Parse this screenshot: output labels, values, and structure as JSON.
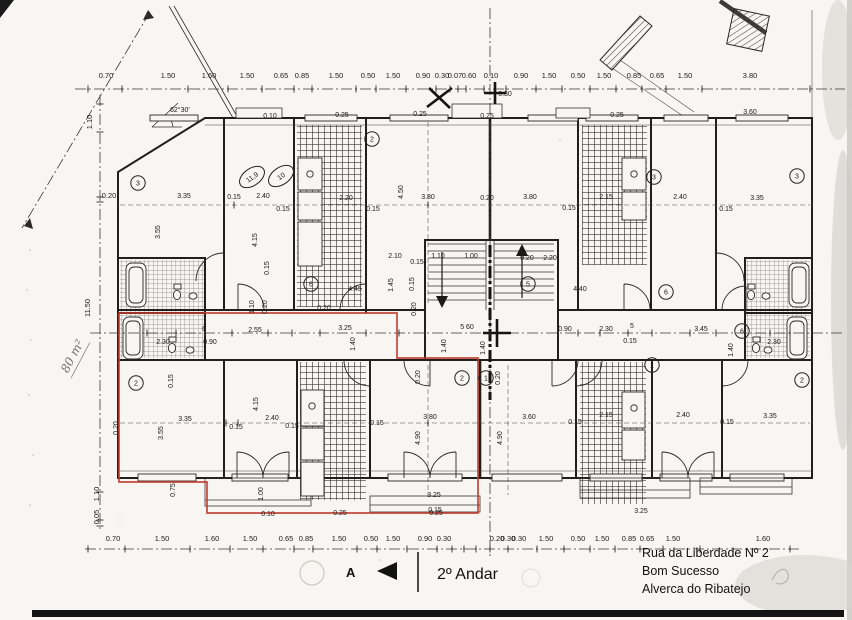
{
  "title": {
    "floor": "2º Andar",
    "marker": "A"
  },
  "address": [
    "Rua da Liberdade Nº 2",
    "Bom Sucesso",
    "Alverca do Ribatejo"
  ],
  "notes": {
    "area_handwritten": "80 m²",
    "angle": "62°30'"
  },
  "colors": {
    "paper": "#f7f6f2",
    "ink": "#1f1e1c",
    "red_outline": "#c0392b",
    "pencil": "#b0ada6"
  },
  "dimensions": {
    "top_row": {
      "y": 78,
      "items": [
        {
          "t": "0.70",
          "x": 106
        },
        {
          "t": "1.50",
          "x": 168
        },
        {
          "t": "1.60",
          "x": 209
        },
        {
          "t": "1.50",
          "x": 247
        },
        {
          "t": "0.65",
          "x": 281
        },
        {
          "t": "0.85",
          "x": 302
        },
        {
          "t": "1.50",
          "x": 336
        },
        {
          "t": "0.50",
          "x": 368
        },
        {
          "t": "1.50",
          "x": 393
        },
        {
          "t": "0.90",
          "x": 423
        },
        {
          "t": "0.30",
          "x": 442
        },
        {
          "t": "0.07",
          "x": 455
        },
        {
          "t": "0.60",
          "x": 469
        },
        {
          "t": "0.10",
          "x": 491
        },
        {
          "t": "0.90",
          "x": 521
        },
        {
          "t": "1.50",
          "x": 549
        },
        {
          "t": "0.50",
          "x": 578
        },
        {
          "t": "1.50",
          "x": 604
        },
        {
          "t": "0.85",
          "x": 634
        },
        {
          "t": "0.65",
          "x": 657
        },
        {
          "t": "1.50",
          "x": 685
        },
        {
          "t": "3.80",
          "x": 750
        }
      ]
    },
    "bottom_row": {
      "y": 541,
      "items": [
        {
          "t": "0.70",
          "x": 113
        },
        {
          "t": "1.50",
          "x": 162
        },
        {
          "t": "1.60",
          "x": 212
        },
        {
          "t": "1.50",
          "x": 250
        },
        {
          "t": "0.65",
          "x": 286
        },
        {
          "t": "0.85",
          "x": 306
        },
        {
          "t": "1.50",
          "x": 339
        },
        {
          "t": "0.50",
          "x": 371
        },
        {
          "t": "1.50",
          "x": 393
        },
        {
          "t": "0.90",
          "x": 425
        },
        {
          "t": "0.30",
          "x": 444
        },
        {
          "t": "0.20",
          "x": 497
        },
        {
          "t": "0.30",
          "x": 508
        },
        {
          "t": "0.30",
          "x": 519
        },
        {
          "t": "1.50",
          "x": 546
        },
        {
          "t": "0.50",
          "x": 578
        },
        {
          "t": "1.50",
          "x": 602
        },
        {
          "t": "0.85",
          "x": 629
        },
        {
          "t": "0.65",
          "x": 647
        },
        {
          "t": "1.50",
          "x": 673
        },
        {
          "t": "1.60",
          "x": 763
        }
      ]
    },
    "left_col": [
      {
        "t": "1.10",
        "x": 92,
        "y": 122,
        "r": -90
      },
      {
        "t": "0.20",
        "x": 109,
        "y": 198
      },
      {
        "t": "11.50",
        "x": 90,
        "y": 308,
        "r": -90
      },
      {
        "t": "1.10",
        "x": 99,
        "y": 494,
        "r": -90
      },
      {
        "t": "0.05",
        "x": 99,
        "y": 517,
        "r": -90
      }
    ],
    "interior": [
      {
        "t": "3.35",
        "x": 184,
        "y": 198
      },
      {
        "t": "0.15",
        "x": 234,
        "y": 199
      },
      {
        "t": "2.40",
        "x": 263,
        "y": 198
      },
      {
        "t": "0.15",
        "x": 283,
        "y": 211
      },
      {
        "t": "3.55",
        "x": 160,
        "y": 232,
        "r": -90
      },
      {
        "t": "4.15",
        "x": 257,
        "y": 240,
        "r": -90
      },
      {
        "t": "0.15",
        "x": 269,
        "y": 268,
        "r": -90
      },
      {
        "t": "2.20",
        "x": 346,
        "y": 200
      },
      {
        "t": "0.15",
        "x": 373,
        "y": 211
      },
      {
        "t": "3.80",
        "x": 428,
        "y": 199
      },
      {
        "t": "4.50",
        "x": 403,
        "y": 192,
        "r": -90
      },
      {
        "t": "0.20",
        "x": 487,
        "y": 200
      },
      {
        "t": "2.10",
        "x": 395,
        "y": 258
      },
      {
        "t": "0.15",
        "x": 417,
        "y": 264
      },
      {
        "t": "1.10",
        "x": 438,
        "y": 258
      },
      {
        "t": "1.00",
        "x": 471,
        "y": 258
      },
      {
        "t": "0.20",
        "x": 527,
        "y": 260
      },
      {
        "t": "2.20",
        "x": 550,
        "y": 260
      },
      {
        "t": "4.45",
        "x": 355,
        "y": 291
      },
      {
        "t": "1.45",
        "x": 393,
        "y": 285,
        "r": -90
      },
      {
        "t": "0.15",
        "x": 414,
        "y": 284,
        "r": -90
      },
      {
        "t": "4.40",
        "x": 580,
        "y": 291
      },
      {
        "t": "3.80",
        "x": 530,
        "y": 199
      },
      {
        "t": "0.15",
        "x": 569,
        "y": 210
      },
      {
        "t": "2.15",
        "x": 606,
        "y": 199
      },
      {
        "t": "2.40",
        "x": 680,
        "y": 199
      },
      {
        "t": "0.15",
        "x": 726,
        "y": 211
      },
      {
        "t": "3.35",
        "x": 757,
        "y": 200
      },
      {
        "t": "6",
        "x": 204,
        "y": 331
      },
      {
        "t": "2.55",
        "x": 255,
        "y": 332
      },
      {
        "t": "0.90",
        "x": 210,
        "y": 344
      },
      {
        "t": "2.30",
        "x": 163,
        "y": 344
      },
      {
        "t": "1.10",
        "x": 254,
        "y": 307,
        "r": -90
      },
      {
        "t": "0.20",
        "x": 267,
        "y": 307,
        "r": -90
      },
      {
        "t": "0.20",
        "x": 324,
        "y": 310
      },
      {
        "t": "3.25",
        "x": 345,
        "y": 330
      },
      {
        "t": "0.20",
        "x": 416,
        "y": 309,
        "r": -90
      },
      {
        "t": "5 60",
        "x": 467,
        "y": 329,
        "s": 8.6
      },
      {
        "t": "1.40",
        "x": 355,
        "y": 344,
        "r": -90
      },
      {
        "t": "1.40",
        "x": 446,
        "y": 346,
        "r": -90
      },
      {
        "t": "1.40",
        "x": 485,
        "y": 348,
        "r": -90
      },
      {
        "t": "0.90",
        "x": 565,
        "y": 331
      },
      {
        "t": "2.30",
        "x": 606,
        "y": 331
      },
      {
        "t": "5",
        "x": 632,
        "y": 328
      },
      {
        "t": "3.45",
        "x": 701,
        "y": 331
      },
      {
        "t": "0.15",
        "x": 630,
        "y": 343
      },
      {
        "t": "2.30",
        "x": 774,
        "y": 344
      },
      {
        "t": "1.40",
        "x": 733,
        "y": 350,
        "r": -90
      },
      {
        "t": "0.20",
        "x": 118,
        "y": 428,
        "r": -90
      },
      {
        "t": "3.55",
        "x": 163,
        "y": 433,
        "r": -90
      },
      {
        "t": "3.35",
        "x": 185,
        "y": 421
      },
      {
        "t": "0.15",
        "x": 236,
        "y": 429
      },
      {
        "t": "4.15",
        "x": 258,
        "y": 404,
        "r": -90
      },
      {
        "t": "2.40",
        "x": 272,
        "y": 420
      },
      {
        "t": "0.15",
        "x": 292,
        "y": 428
      },
      {
        "t": "0.15",
        "x": 173,
        "y": 381,
        "r": -90
      },
      {
        "t": "0.75",
        "x": 175,
        "y": 490,
        "r": -90
      },
      {
        "t": "1.00",
        "x": 263,
        "y": 494,
        "r": -90
      },
      {
        "t": "0.20",
        "x": 420,
        "y": 377,
        "r": -90
      },
      {
        "t": "3.80",
        "x": 430,
        "y": 419
      },
      {
        "t": "0.15",
        "x": 377,
        "y": 425
      },
      {
        "t": "4.90",
        "x": 420,
        "y": 438,
        "r": -90
      },
      {
        "t": "3.25",
        "x": 434,
        "y": 497
      },
      {
        "t": "0.15",
        "x": 435,
        "y": 512
      },
      {
        "t": "0.20",
        "x": 500,
        "y": 378,
        "r": -90
      },
      {
        "t": "3.60",
        "x": 529,
        "y": 419
      },
      {
        "t": "4.90",
        "x": 502,
        "y": 438,
        "r": -90
      },
      {
        "t": "0.15",
        "x": 575,
        "y": 424
      },
      {
        "t": "2.15",
        "x": 606,
        "y": 417
      },
      {
        "t": "2.40",
        "x": 683,
        "y": 417
      },
      {
        "t": "0.15",
        "x": 727,
        "y": 424
      },
      {
        "t": "3.35",
        "x": 770,
        "y": 418
      },
      {
        "t": "3.25",
        "x": 641,
        "y": 513
      },
      {
        "t": "0.10",
        "x": 270,
        "y": 118
      },
      {
        "t": "0.25",
        "x": 342,
        "y": 117
      },
      {
        "t": "0.25",
        "x": 420,
        "y": 116
      },
      {
        "t": "0.25",
        "x": 487,
        "y": 118
      },
      {
        "t": "0.25",
        "x": 617,
        "y": 117
      },
      {
        "t": "0.30",
        "x": 505,
        "y": 96
      },
      {
        "t": "3.60",
        "x": 750,
        "y": 114,
        "s": 8
      },
      {
        "t": "0.10",
        "x": 268,
        "y": 516
      },
      {
        "t": "0.25",
        "x": 340,
        "y": 515
      },
      {
        "t": "0.25",
        "x": 436,
        "y": 515
      }
    ]
  },
  "rooms": {
    "circled": [
      {
        "n": "3",
        "x": 138,
        "y": 183
      },
      {
        "n": "2",
        "x": 372,
        "y": 139
      },
      {
        "n": "3",
        "x": 654,
        "y": 177
      },
      {
        "n": "3",
        "x": 797,
        "y": 176
      },
      {
        "n": "6",
        "x": 311,
        "y": 284
      },
      {
        "n": "5",
        "x": 528,
        "y": 284
      },
      {
        "n": "6",
        "x": 666,
        "y": 292
      },
      {
        "n": "6",
        "x": 742,
        "y": 331
      },
      {
        "n": "2",
        "x": 136,
        "y": 383
      },
      {
        "n": "2",
        "x": 462,
        "y": 378
      },
      {
        "n": "1",
        "x": 486,
        "y": 378
      },
      {
        "n": "1",
        "x": 652,
        "y": 365
      },
      {
        "n": "2",
        "x": 802,
        "y": 380
      }
    ],
    "ellipse_areas": [
      {
        "t": "11,9",
        "x": 252,
        "y": 177,
        "r": -35
      },
      {
        "t": "10",
        "x": 281,
        "y": 176,
        "r": -35
      }
    ]
  }
}
